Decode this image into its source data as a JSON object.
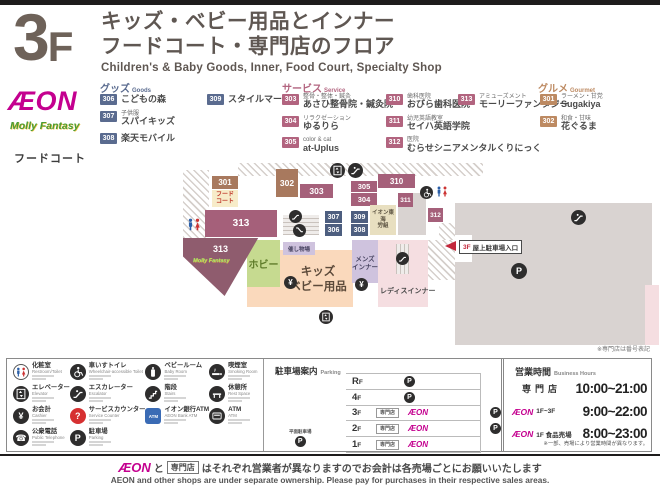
{
  "header": {
    "floor_number": "3",
    "floor_letter": "F",
    "title_jp_line1": "キッズ・ベビー用品とインナー",
    "title_jp_line2": "フードコート・専門店のフロア",
    "title_en": "Children's & Baby Goods, Inner, Food Court, Specialty Shop"
  },
  "brand": {
    "aeon_logo": "ÆON",
    "molly_logo": "Molly Fantasy",
    "food_court_label": "フードコート"
  },
  "colors": {
    "aeon_magenta": "#c4008f",
    "goods_badge": "#5a6b8f",
    "service_badge": "#b2647f",
    "gourmet_badge": "#bd8a62",
    "map_brown": "#a8795e",
    "map_maroon": "#a5607a",
    "map_blue": "#4d5e7f",
    "map_green": "#c6da90",
    "map_peach": "#fad9bc",
    "map_lavender": "#cfc3de",
    "map_pink": "#f5dee1",
    "map_gray": "#d9d3d1"
  },
  "directory": {
    "goods": {
      "title": "グッズ",
      "subtitle": "Goods",
      "items": [
        {
          "num": "306",
          "cat": "",
          "name": "こどもの森"
        },
        {
          "num": "307",
          "cat": "子供服",
          "name": "スパイキッズ"
        },
        {
          "num": "308",
          "cat": "",
          "name": "楽天モバイル"
        },
        {
          "num": "309",
          "cat": "",
          "name": "スタイルマート"
        }
      ]
    },
    "service": {
      "title": "サービス",
      "subtitle": "Service",
      "items": [
        {
          "num": "303",
          "cat": "整骨・整体・鍼灸",
          "name": "あさひ整骨院・鍼灸院"
        },
        {
          "num": "304",
          "cat": "リラクゼーション",
          "name": "ゆるりら"
        },
        {
          "num": "305",
          "cat": "color & cat",
          "name": "at-Uplus"
        },
        {
          "num": "310",
          "cat": "歯科医院",
          "name": "おびら歯科医院"
        },
        {
          "num": "311",
          "cat": "幼児英語教室",
          "name": "セイハ英語学院"
        },
        {
          "num": "312",
          "cat": "医院",
          "name": "むらせシニアメンタルくりにっく"
        },
        {
          "num": "313",
          "cat": "アミューズメント",
          "name": "モーリーファンタジー"
        }
      ]
    },
    "gourmet": {
      "title": "グルメ",
      "subtitle": "Gourmet",
      "items": [
        {
          "num": "301",
          "cat": "ラーメン・甘党",
          "name": "Sugakiya"
        },
        {
          "num": "302",
          "cat": "和食・甘味",
          "name": "花ぐるま"
        }
      ]
    }
  },
  "map": {
    "blocks": {
      "b301": "301",
      "food_court_line1": "フード",
      "food_court_line2": "コート",
      "b302": "302",
      "b303": "303",
      "b304": "304",
      "b305": "305",
      "b306": "306",
      "b307": "307",
      "b308": "308",
      "b309": "309",
      "b310": "310",
      "b311": "311",
      "b312": "312",
      "b313_center": "313",
      "b313_molly": "313",
      "molly_logo": "Molly Fantasy",
      "office_line1": "イオン東海",
      "office_line2": "労組",
      "hobby": "ホビー",
      "event_space": "催し物場",
      "kids_line1": "キッズ",
      "kids_line2": "ベビー用品",
      "mens_line1": "メンズ",
      "mens_line2": "インナー",
      "ladies": "レディスインナー"
    },
    "entrance": {
      "floor": "3F",
      "label": "屋上駐車場入口"
    },
    "note": "※専門店は番号表記"
  },
  "legend": {
    "items": [
      {
        "icon": "restroom",
        "jp": "化粧室",
        "en": "Restroom/Toilet"
      },
      {
        "icon": "wheelchair",
        "jp": "車いすトイレ",
        "en": "Wheelchair-accessible Toilet"
      },
      {
        "icon": "baby",
        "jp": "ベビールーム",
        "en": "Baby Room"
      },
      {
        "icon": "smoking",
        "jp": "喫煙室",
        "en": "Smoking Room"
      },
      {
        "icon": "elevator",
        "jp": "エレベーター",
        "en": "Elevator"
      },
      {
        "icon": "escalator",
        "jp": "エスカレーター",
        "en": "Escalator"
      },
      {
        "icon": "stairs",
        "jp": "階段",
        "en": "Stairs"
      },
      {
        "icon": "rest",
        "jp": "休憩所",
        "en": "Rest Space"
      },
      {
        "icon": "cashier",
        "jp": "お会計",
        "en": "Cashier"
      },
      {
        "icon": "service",
        "jp": "サービスカウンター",
        "en": "Service Counter"
      },
      {
        "icon": "aeonbank",
        "jp": "イオン銀行ATM",
        "en": "AEON Bank ATM"
      },
      {
        "icon": "atm",
        "jp": "ATM",
        "en": "ATM"
      },
      {
        "icon": "phone",
        "jp": "公衆電話",
        "en": "Public Telephone"
      },
      {
        "icon": "parking",
        "jp": "駐車場",
        "en": "Parking"
      }
    ]
  },
  "parking": {
    "title_jp": "駐車場案内",
    "title_en": "Parking",
    "surface_label": "平面駐車場",
    "senmonten_label": "専門店",
    "aeon_label": "ÆON",
    "rows": [
      {
        "floor": "RF",
        "layout": "p"
      },
      {
        "floor": "4F",
        "layout": "p"
      },
      {
        "floor": "3F",
        "layout": "shops_p"
      },
      {
        "floor": "2F",
        "layout": "shops_p"
      },
      {
        "floor": "1F",
        "layout": "shops"
      }
    ]
  },
  "hours": {
    "title_jp": "営業時間",
    "title_en": "Business Hours",
    "aeon_label": "ÆON",
    "rows": [
      {
        "label": "専門店",
        "time": "10:00~21:00"
      },
      {
        "label": "1F~3F",
        "time": "9:00~22:00"
      },
      {
        "label": "1F 食品売場",
        "time": "8:00~23:00"
      }
    ],
    "note": "※一部、売場により営業時間が異なります。"
  },
  "footer": {
    "aeon": "ÆON",
    "to": "と",
    "senmonten": "専門店",
    "jp_rest": "はそれぞれ営業者が異なりますのでお会計は各売場ごとにお願いいたします",
    "en": "AEON and other shops are under separate ownership. Please pay for purchases in their respective sales areas."
  }
}
